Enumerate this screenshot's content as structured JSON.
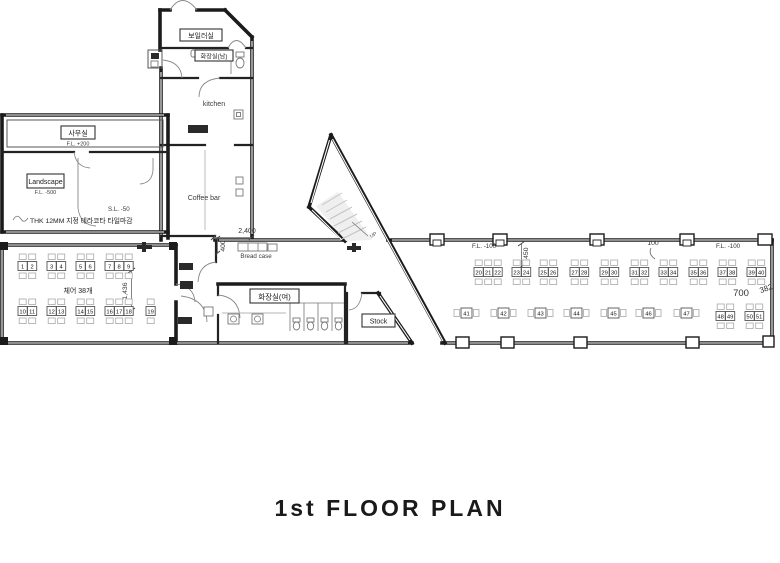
{
  "title": "1st FLOOR PLAN",
  "rooms": {
    "boiler": "보일러실",
    "restroom_men": "화장실(남)",
    "kitchen": "kitchen",
    "coffee_bar": "Coffee bar",
    "bread_case": "Bread case",
    "office": "사무실",
    "office_level": "F.L. +200",
    "landscape": "Landscape",
    "landscape_level": "F.L. -500",
    "slab_level": "S.L. -50",
    "finish_note": "THK 12MM 지정 테라코타 타일마감",
    "chair_count_note": "체어 38개",
    "restroom_women": "화장실(여)",
    "stock": "Stock",
    "stair_up": "UP",
    "floor_level_left": "F.L. -100",
    "floor_level_right": "F.L. -100"
  },
  "dimensions": {
    "corridor_width": "2,400",
    "bread_case_depth": "400",
    "hall_depth": "1,436",
    "wing_bay": "1,450",
    "wing_offset": "100",
    "wing_width": "700",
    "wing_end": "382"
  },
  "colors": {
    "wall": "#1b1b1b",
    "furniture_outline": "#a8a8a8",
    "dimension_text": "#333333",
    "background": "#ffffff"
  },
  "seating": {
    "groups": [
      {
        "x": 18,
        "y": 254,
        "nums": [
          "1",
          "2"
        ]
      },
      {
        "x": 47,
        "y": 254,
        "nums": [
          "3",
          "4"
        ]
      },
      {
        "x": 76,
        "y": 254,
        "nums": [
          "5",
          "6"
        ]
      },
      {
        "x": 105,
        "y": 254,
        "nums": [
          "7",
          "8",
          "9"
        ]
      },
      {
        "x": 18,
        "y": 299,
        "nums": [
          "10",
          "11"
        ]
      },
      {
        "x": 47,
        "y": 299,
        "nums": [
          "12",
          "13"
        ]
      },
      {
        "x": 76,
        "y": 299,
        "nums": [
          "14",
          "15"
        ]
      },
      {
        "x": 105,
        "y": 299,
        "nums": [
          "16",
          "17",
          "18"
        ]
      },
      {
        "x": 146,
        "y": 299,
        "nums": [
          "19"
        ]
      },
      {
        "x": 474,
        "y": 260,
        "nums": [
          "20",
          "21",
          "22"
        ]
      },
      {
        "x": 512,
        "y": 260,
        "nums": [
          "23",
          "24"
        ]
      },
      {
        "x": 539,
        "y": 260,
        "nums": [
          "25",
          "26"
        ]
      },
      {
        "x": 570,
        "y": 260,
        "nums": [
          "27",
          "28"
        ]
      },
      {
        "x": 600,
        "y": 260,
        "nums": [
          "29",
          "30"
        ]
      },
      {
        "x": 630,
        "y": 260,
        "nums": [
          "31",
          "32"
        ]
      },
      {
        "x": 659,
        "y": 260,
        "nums": [
          "33",
          "34"
        ]
      },
      {
        "x": 689,
        "y": 260,
        "nums": [
          "35",
          "36"
        ]
      },
      {
        "x": 718,
        "y": 260,
        "nums": [
          "37",
          "38"
        ]
      },
      {
        "x": 747,
        "y": 260,
        "nums": [
          "39",
          "40"
        ]
      },
      {
        "x": 454,
        "y": 308,
        "type": "single",
        "nums": [
          "41"
        ]
      },
      {
        "x": 491,
        "y": 308,
        "type": "single",
        "nums": [
          "42"
        ]
      },
      {
        "x": 528,
        "y": 308,
        "type": "single",
        "nums": [
          "43"
        ]
      },
      {
        "x": 564,
        "y": 308,
        "type": "single",
        "nums": [
          "44"
        ]
      },
      {
        "x": 601,
        "y": 308,
        "type": "single",
        "nums": [
          "45"
        ]
      },
      {
        "x": 636,
        "y": 308,
        "type": "single",
        "nums": [
          "46"
        ]
      },
      {
        "x": 674,
        "y": 308,
        "type": "single",
        "nums": [
          "47"
        ]
      },
      {
        "x": 716,
        "y": 304,
        "nums": [
          "48",
          "49"
        ]
      },
      {
        "x": 745,
        "y": 304,
        "nums": [
          "50",
          "51"
        ]
      }
    ]
  }
}
